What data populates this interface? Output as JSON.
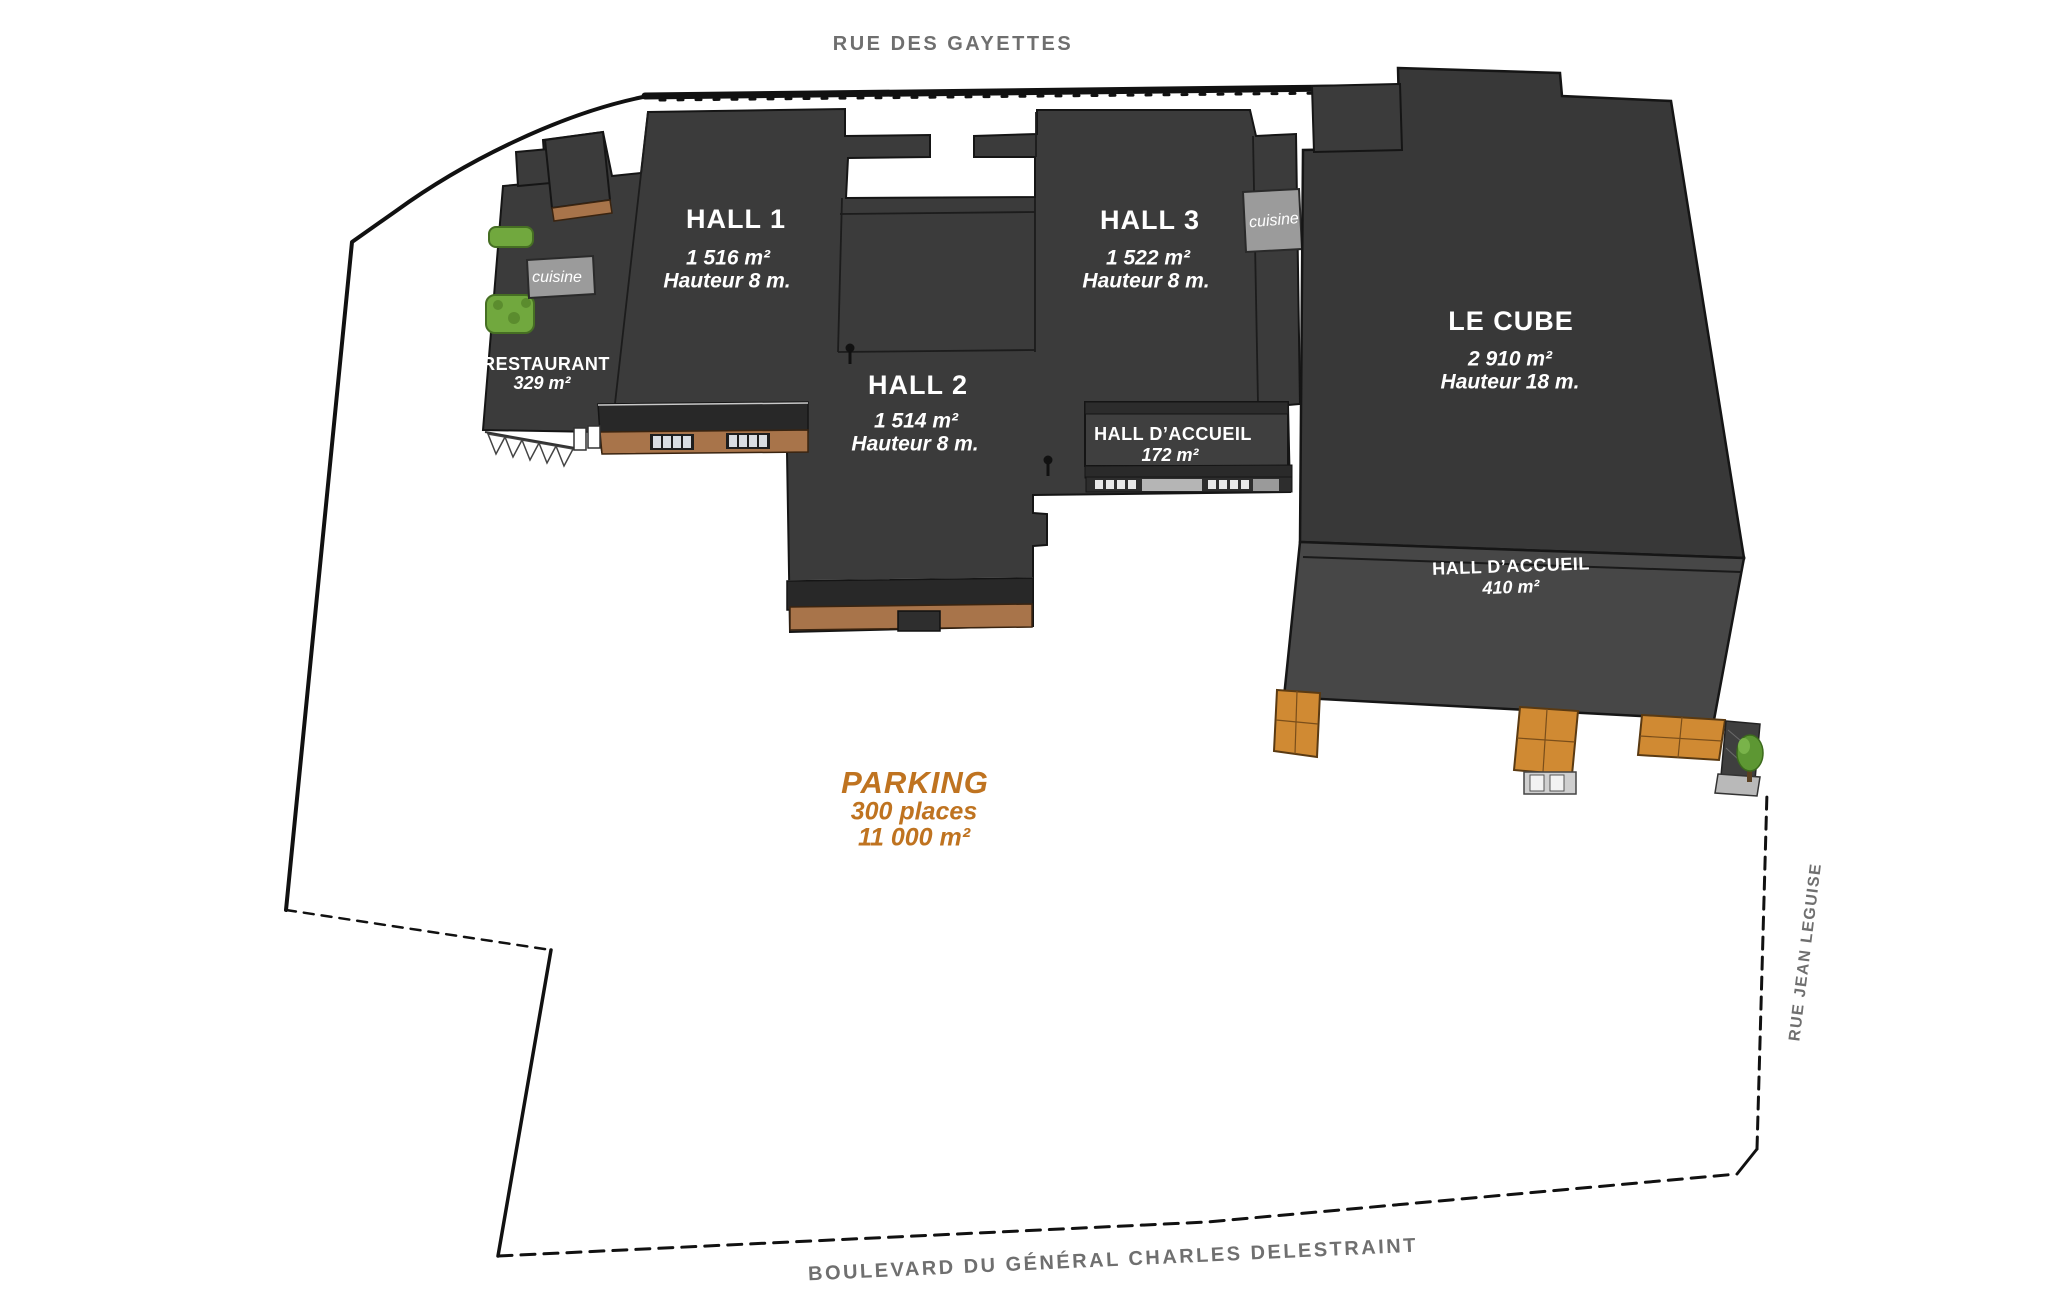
{
  "streets": {
    "top": "RUE DES GAYETTES",
    "right": "RUE JEAN LEGUISE",
    "bottom": "BOULEVARD DU GÉNÉRAL CHARLES DELESTRAINT"
  },
  "buildings": {
    "hall1": {
      "title": "HALL 1",
      "area": "1 516 m²",
      "height": "Hauteur 8 m."
    },
    "hall2": {
      "title": "HALL 2",
      "area": "1 514 m²",
      "height": "Hauteur 8 m."
    },
    "hall3": {
      "title": "HALL 3",
      "area": "1 522 m²",
      "height": "Hauteur 8 m."
    },
    "le_cube": {
      "title": "LE CUBE",
      "area": "2 910 m²",
      "height": "Hauteur 18 m."
    },
    "restaurant": {
      "title": "RESTAURANT",
      "area": "329 m²"
    },
    "hall_accueil_north": {
      "title": "HALL D’ACCUEIL",
      "area": "172 m²"
    },
    "hall_accueil_cube": {
      "title": "HALL D’ACCUEIL",
      "area": "410 m²"
    },
    "cuisine_west": {
      "label": "cuisine"
    },
    "cuisine_east": {
      "label": "cuisine"
    }
  },
  "parking": {
    "title": "PARKING",
    "places": "300 places",
    "area": "11 000 m²"
  },
  "colors": {
    "roof_dark": "#3b3b3b",
    "roof_cube": "#383838",
    "roof_accueil": "#474747",
    "front_face": "#282828",
    "brown_base": "#a8744a",
    "pillar_orange": "#d08a33",
    "cuisine_bg": "#9b9b9b",
    "street_text": "#6f6f6f",
    "parking_text": "#bf7320",
    "bush_green": "#71a83e",
    "boundary": "#111111"
  }
}
